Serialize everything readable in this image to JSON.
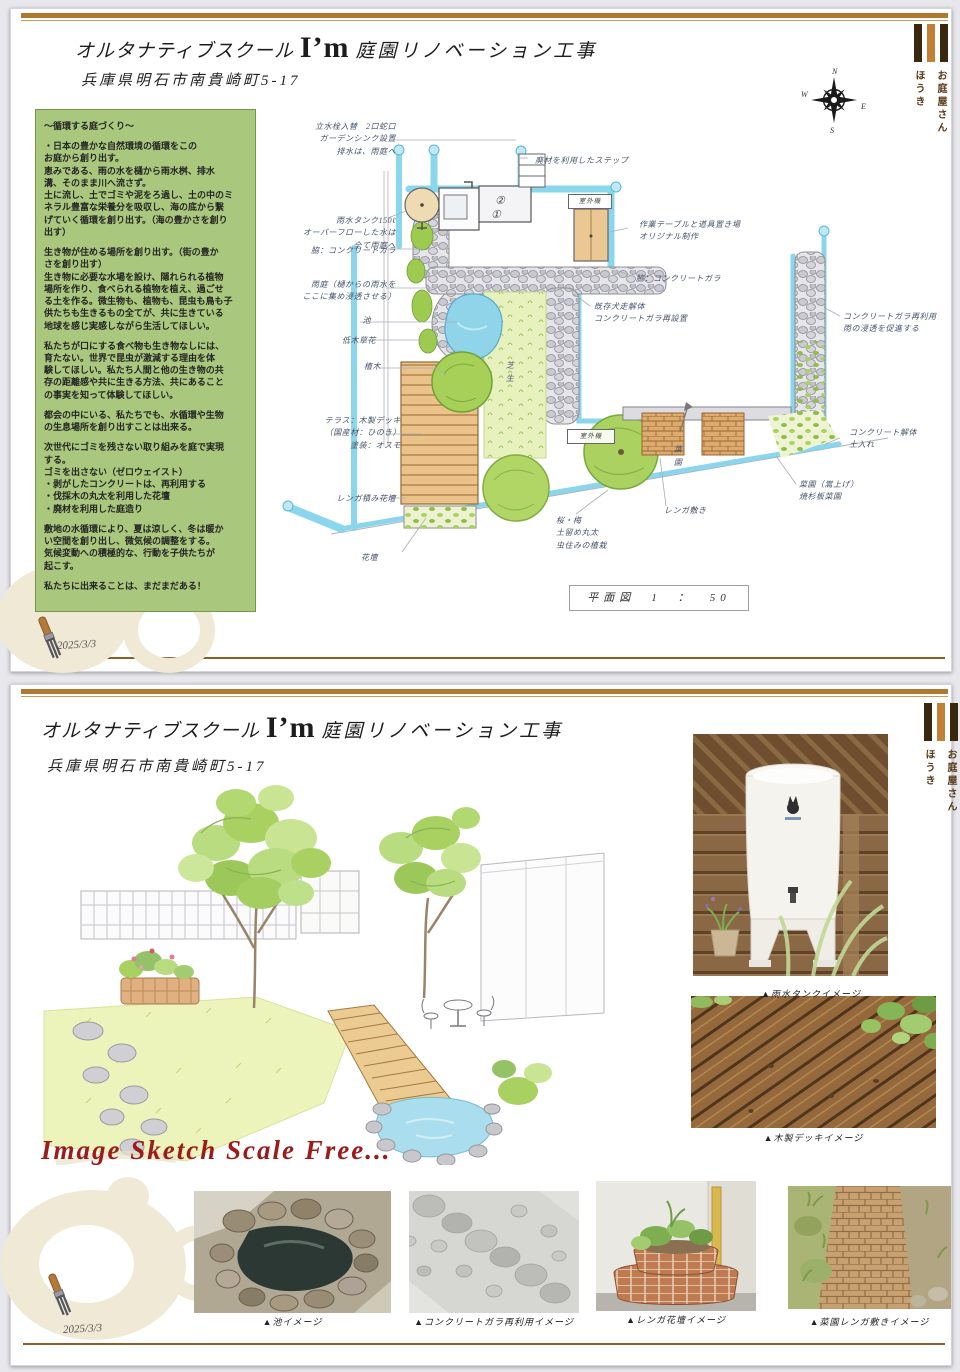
{
  "doc": {
    "title_prefix": "オルタナティブスクール",
    "title_name": "I’m",
    "title_suffix": "庭園リノベーション工事",
    "address": "兵庫県明石市南貴崎町5-17",
    "date": "2025/3/3",
    "logo": {
      "shop": "お庭屋さん",
      "name": "ほうき"
    },
    "compass": {
      "n": "N",
      "e": "E",
      "s": "S",
      "w": "W"
    }
  },
  "concept": {
    "title": "～循環する庭づくり～",
    "paragraphs": [
      "・日本の豊かな自然環境の循環をこの\nお庭から創り出す。\n恵みである、雨の水を樋から雨水桝、排水\n溝、そのまま川へ流さず。\n土に流し、土でゴミや泥をろ過し、土の中のミ\nネラル豊富な栄養分を吸収し、海の底から繋\nげていく循環を創り出す。（海の豊かさを創り\n出す）",
      "生き物が住める場所を創り出す。（街の豊か\nさを創り出す）\n生き物に必要な水場を設け、隠れられる植物\n場所を作り、食べられる植物を植え、過ごせ\nる土を作る。微生物も、植物も、昆虫も鳥も子\n供たちも生きるもの全てが、共に生きている\n地球を感じ実感しながら生活してほしい。",
      "私たちが口にする食べ物も生き物なしには、\n育たない。世界で昆虫が激減する理由を体\n験してほしい。私たち人間と他の生き物の共\n存の距離感や共に生きる方法、共にあること\nの事実を知って体験してほしい。",
      "都会の中にいる、私たちでも、水循環や生物\nの生息場所を創り出すことは出来る。",
      "次世代にゴミを残さない取り組みを庭で実現\nする。\nゴミを出さない（ゼロウェイスト）\n・剥がしたコンクリートは、再利用する\n・伐採木の丸太を利用した花壇\n・廃材を利用した庭造り",
      "敷地の水循環により、夏は涼しく、冬は暖か\nい空間を創り出し、微気候の調整をする。\n気候変動への積極的な、行動を子供たちが\n起こす。",
      "私たちに出来ることは、まだまだある！"
    ]
  },
  "plan": {
    "scale_label": "平面図　1　：　50",
    "unit_upper": "②",
    "unit_lower": "①",
    "labels": {
      "tap": "立水栓入替　2口蛇口\nガーデンシンク設置\n排水は、雨庭へ",
      "tank": "雨水タンク150ℓ\nオーバーフローした水は\n全て雨庭へ",
      "edge_left": "脇：コンクリートガラ",
      "rain_garden": "雨庭（樋からの雨水を\nここに集め浸透させる）",
      "pond": "池",
      "low_plants": "低木草花",
      "tree": "植木",
      "terrace": "テラス：木製デッキ\n（国産材：ひのき）\n塗装：オスモ",
      "brick_bed": "レンガ積み花壇",
      "flower_bed": "花壇",
      "step": "廃材を利用したステップ",
      "work_table": "作業テーブルと道具置き場\nオリジナル制作",
      "edge_right": "脇：コンクリートガラ",
      "dog_run": "既存犬走解体\nコンクリートガラ再設置",
      "gravel_reuse": "コンクリートガラ再利用\n雨の浸透を促進する",
      "concrete_soil": "コンクリート解体\n土入れ",
      "veg_raised": "菜園（嵩上げ）\n焼杉板菜園",
      "veg_garden": "菜園",
      "brick_paving": "レンガ敷き",
      "sakura": "桜・梅\n土留め丸太\n虫住みの植栽",
      "lawn": "芝生",
      "outdoor_unit": "室外機"
    }
  },
  "page2": {
    "sketch_caption": "Image Sketch Scale Free...",
    "photos": {
      "rain_tank": "▲雨水タンクイメージ",
      "wood_deck": "▲木製デッキイメージ",
      "pond": "▲池イメージ",
      "concrete": "▲コンクリートガラ再利用イメージ",
      "brick_bed": "▲レンガ花壇イメージ",
      "veg_brick": "▲菜園レンガ敷きイメージ"
    }
  },
  "colors": {
    "accent_rule": "#b0772e",
    "logo_dark": "#3a2710",
    "logo_orange": "#c08136",
    "concept_bg": "#a9c77d",
    "red_caption": "#9c1c1c",
    "pipe_blue": "#7ed2ea"
  }
}
